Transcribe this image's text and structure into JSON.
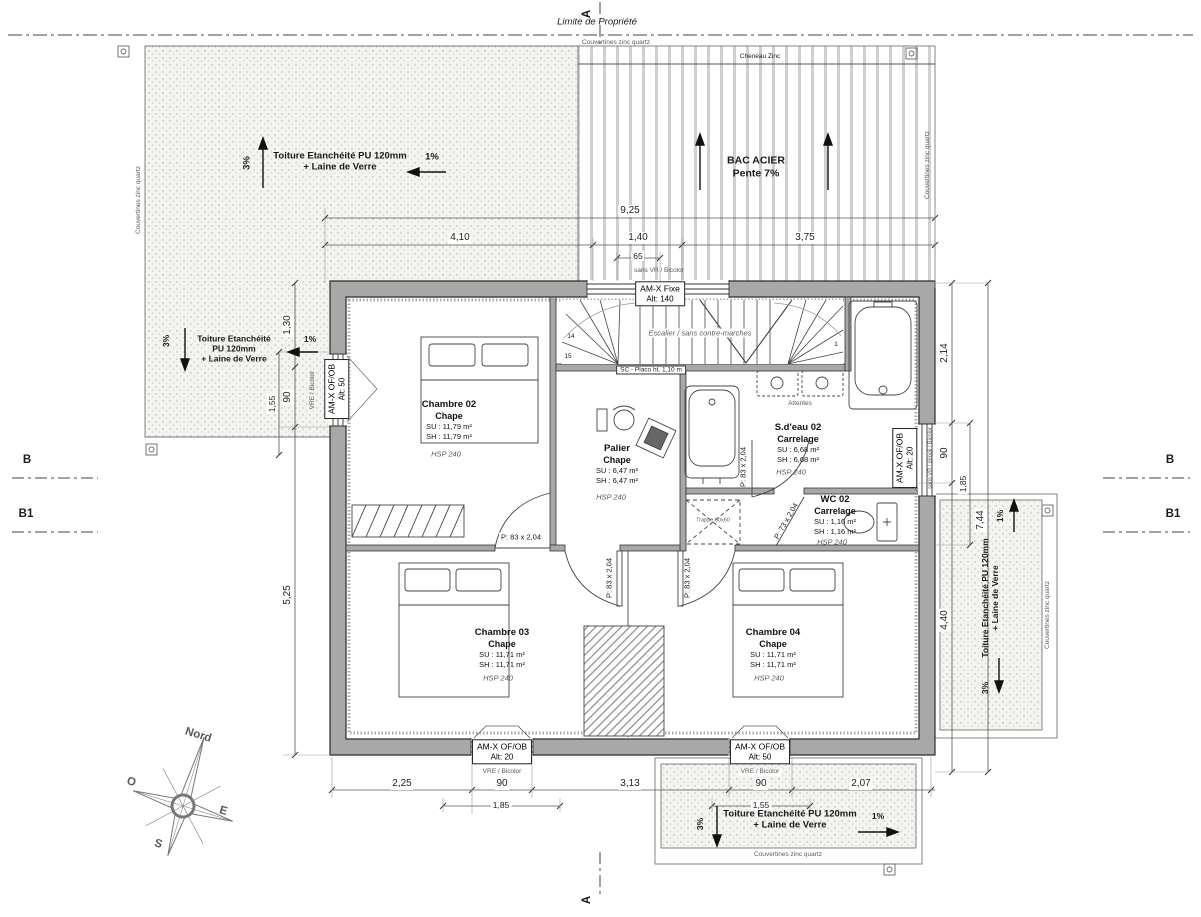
{
  "colors": {
    "paper": "#ffffff",
    "wall_fill": "#a8a8a8",
    "stipple_dot": "#b5b5ac",
    "line": "#2b2b2b"
  },
  "meta": {
    "property_line": "Limite de Propriété",
    "section_a": "A",
    "section_b": "B",
    "section_b1": "B1"
  },
  "edge": {
    "couvertines": "Couvertines zinc quartz",
    "cheneau": "Cheneau Zinc"
  },
  "roofs": {
    "top_left": {
      "name": "Toiture Etanchéité PU 120mm\n+ Laine de Verre",
      "main": "3%",
      "minor": "1%"
    },
    "left": {
      "name": "Toiture Etanchéité\nPU 120mm\n+ Laine de Verre",
      "main": "3%",
      "minor": "1%"
    },
    "right": {
      "name": "Toiture Etanchéité PU 120mm\n+ Laine de Verre",
      "main": "3%",
      "minor": "1%"
    },
    "bottom": {
      "name": "Toiture Etanchéité PU 120mm\n+ Laine de Verre",
      "main": "3%",
      "minor": "1%"
    },
    "bac": {
      "name": "BAC ACIER\nPente 7%"
    }
  },
  "rooms": {
    "chambre02": {
      "name": "Chambre 02",
      "finish": "Chape",
      "su": "SU : 11,79 m²",
      "sh": "SH : 11,79 m²",
      "hsp": "HSP 240"
    },
    "chambre03": {
      "name": "Chambre 03",
      "finish": "Chape",
      "su": "SU : 11,71 m²",
      "sh": "SH : 11,71 m²",
      "hsp": "HSP 240"
    },
    "chambre04": {
      "name": "Chambre 04",
      "finish": "Chape",
      "su": "SU : 11,71 m²",
      "sh": "SH : 11,71 m²",
      "hsp": "HSP 240"
    },
    "palier": {
      "name": "Palier",
      "finish": "Chape",
      "su": "SU : 6,47 m²",
      "sh": "SH : 6,47 m²",
      "hsp": "HSP 240"
    },
    "sdeau02": {
      "name": "S.d'eau 02",
      "finish": "Carrelage",
      "su": "SU : 6,68 m²",
      "sh": "SH : 6,68 m²",
      "hsp": "HSP 240"
    },
    "wc02": {
      "name": "WC 02",
      "finish": "Carrelage",
      "su": "SU : 1,16 m²",
      "sh": "SH : 1,16 m²",
      "hsp": "HSP 240"
    }
  },
  "windows": {
    "top": {
      "name": "AM-X Fixe",
      "alt": "Alt:  140",
      "note": "sans VR / Bicolor"
    },
    "left": {
      "name": "AM-X OF/OB",
      "alt": "Alt:  50",
      "note": "VRE / Bicolor"
    },
    "right": {
      "name": "AM-X OF/OB",
      "alt": "Alt:  20",
      "note": "sans VR / dépoli / Bicolor"
    },
    "bottom_left": {
      "name": "AM-X OF/OB",
      "alt": "Alt:  20",
      "note": "VRE / Bicolor"
    },
    "bottom_right": {
      "name": "AM-X OF/OB",
      "alt": "Alt:  50",
      "note": "VRE / Bicolor"
    }
  },
  "doors": {
    "p83": "P: 83 x 2,04",
    "p73": "P: 73 x 2,04"
  },
  "stairs": {
    "label": "Escalier / sans contre-marches",
    "sc": "SC - Placo ht. 1,10 m",
    "n14": "14",
    "n15": "15",
    "n1": "1"
  },
  "misc": {
    "attentes": "Attentes",
    "trappe": "Trappe 60x60"
  },
  "compass": {
    "north": "Nord",
    "west": "O",
    "east": "E",
    "south": "S"
  },
  "dims": {
    "top_total": "9,25",
    "top_left": "4,10",
    "top_mid": "1,40",
    "top_mid_sub": "65",
    "top_right": "3,75",
    "left_1": "1,30",
    "left_2": "90",
    "left_3": "1,55",
    "left_4": "5,25",
    "right_1": "2,14",
    "right_2": "90",
    "right_3": "1,85",
    "right_4": "4,40",
    "right_total": "7,44",
    "bottom_1": "2,25",
    "bottom_2": "90",
    "bottom_3": "1,85",
    "bottom_4": "3,13",
    "bottom_5": "90",
    "bottom_6": "1,55",
    "bottom_7": "2,07"
  }
}
